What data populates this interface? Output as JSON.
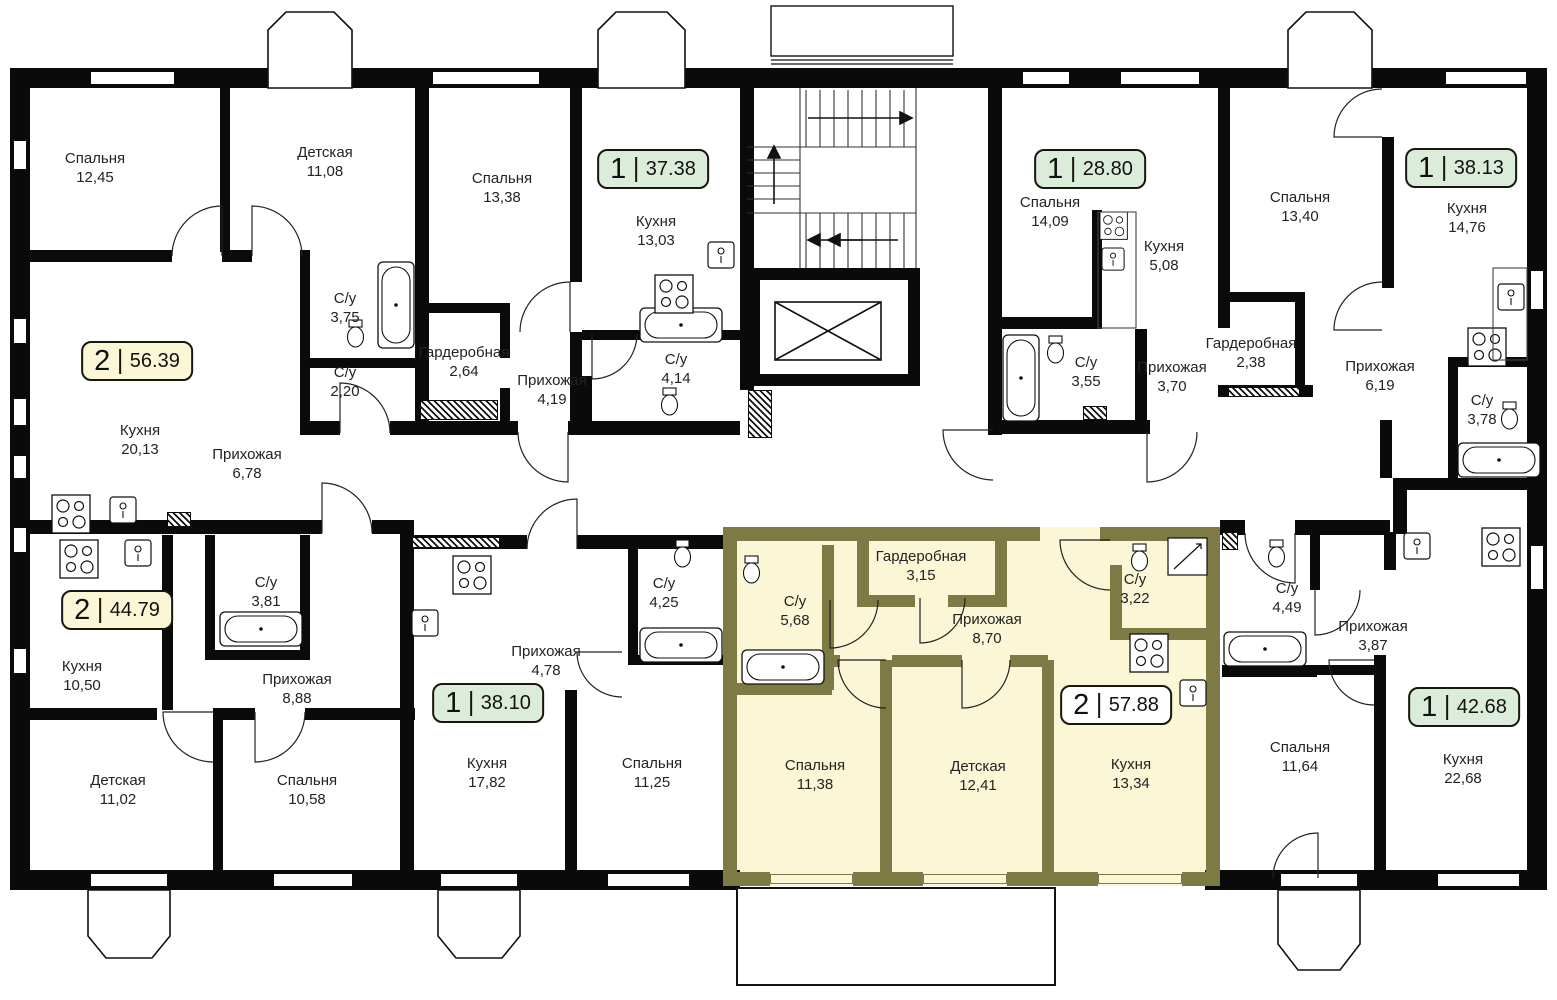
{
  "palette": {
    "wall": "#0a0a0a",
    "highlight_fill": "#faf6d6",
    "highlight_wall": "#7d7a43",
    "badge_green": "#dcecdb",
    "badge_yellow": "#faf6d6",
    "badge_white": "#ffffff"
  },
  "apartments": [
    {
      "rooms_count": "2",
      "area": "56.39",
      "style": "yellow"
    },
    {
      "rooms_count": "1",
      "area": "37.38",
      "style": "green"
    },
    {
      "rooms_count": "1",
      "area": "28.80",
      "style": "green"
    },
    {
      "rooms_count": "1",
      "area": "38.13",
      "style": "green"
    },
    {
      "rooms_count": "2",
      "area": "44.79",
      "style": "yellow"
    },
    {
      "rooms_count": "1",
      "area": "38.10",
      "style": "green"
    },
    {
      "rooms_count": "2",
      "area": "57.88",
      "style": "white",
      "highlighted": true
    },
    {
      "rooms_count": "1",
      "area": "42.68",
      "style": "green"
    }
  ],
  "rooms": [
    {
      "name": "Спальня",
      "area": "12,45"
    },
    {
      "name": "Детская",
      "area": "11,08"
    },
    {
      "name": "С/у",
      "area": "3,75"
    },
    {
      "name": "С/у",
      "area": "2,20"
    },
    {
      "name": "Кухня",
      "area": "20,13"
    },
    {
      "name": "Прихожая",
      "area": "6,78"
    },
    {
      "name": "Спальня",
      "area": "13,38"
    },
    {
      "name": "Кухня",
      "area": "13,03"
    },
    {
      "name": "Гардеробная",
      "area": "2,64"
    },
    {
      "name": "Прихожая",
      "area": "4,19"
    },
    {
      "name": "С/у",
      "area": "4,14"
    },
    {
      "name": "Спальня",
      "area": "14,09"
    },
    {
      "name": "Кухня",
      "area": "5,08"
    },
    {
      "name": "С/у",
      "area": "3,55"
    },
    {
      "name": "Прихожая",
      "area": "3,70"
    },
    {
      "name": "Гардеробная",
      "area": "2,38"
    },
    {
      "name": "Спальня",
      "area": "13,40"
    },
    {
      "name": "Кухня",
      "area": "14,76"
    },
    {
      "name": "Прихожая",
      "area": "6,19"
    },
    {
      "name": "С/у",
      "area": "3,78"
    },
    {
      "name": "Кухня",
      "area": "10,50"
    },
    {
      "name": "С/у",
      "area": "3,81"
    },
    {
      "name": "Прихожая",
      "area": "8,88"
    },
    {
      "name": "Детская",
      "area": "11,02"
    },
    {
      "name": "Спальня",
      "area": "10,58"
    },
    {
      "name": "Прихожая",
      "area": "4,78"
    },
    {
      "name": "С/у",
      "area": "4,25"
    },
    {
      "name": "Кухня",
      "area": "17,82"
    },
    {
      "name": "Спальня",
      "area": "11,25"
    },
    {
      "name": "С/у",
      "area": "5,68"
    },
    {
      "name": "Гардеробная",
      "area": "3,15"
    },
    {
      "name": "Прихожая",
      "area": "8,70"
    },
    {
      "name": "С/у",
      "area": "3,22"
    },
    {
      "name": "Спальня",
      "area": "11,38"
    },
    {
      "name": "Детская",
      "area": "12,41"
    },
    {
      "name": "Кухня",
      "area": "13,34"
    },
    {
      "name": "С/у",
      "area": "4,49"
    },
    {
      "name": "Прихожая",
      "area": "3,87"
    },
    {
      "name": "Спальня",
      "area": "11,64"
    },
    {
      "name": "Кухня",
      "area": "22,68"
    }
  ]
}
